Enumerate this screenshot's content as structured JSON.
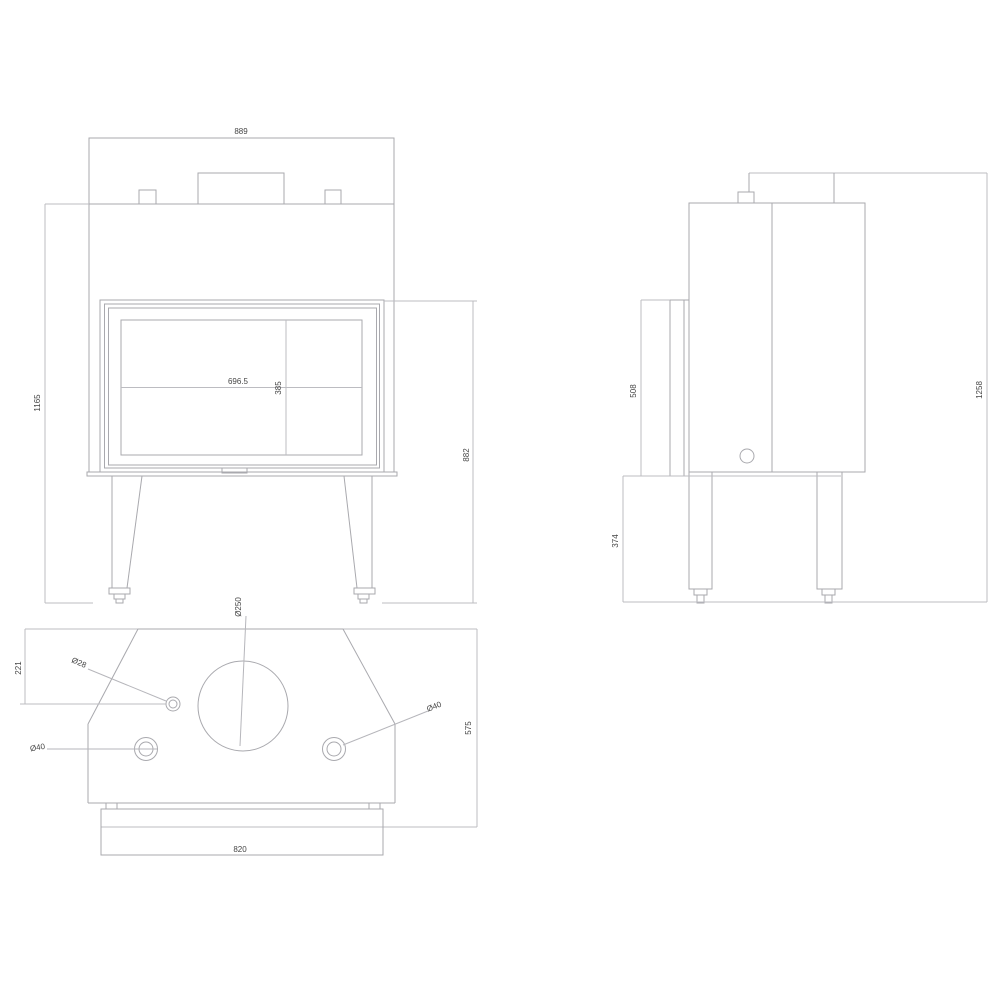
{
  "page": {
    "background": "#ffffff"
  },
  "drawing": {
    "type": "technical-drawing",
    "subject": "fireplace insert, three orthographic views",
    "line_color": "#a9a9ae",
    "dim_line_color": "#bcbcc1",
    "text_color": "#454545",
    "views": [
      {
        "id": "front",
        "title": "front view"
      },
      {
        "id": "side",
        "title": "side view"
      },
      {
        "id": "top",
        "title": "top view"
      }
    ],
    "dimensions": {
      "front_width": "889",
      "front_total_height": "1165",
      "front_body_height": "882",
      "glass_width": "696.5",
      "glass_height": "385",
      "side_door_height": "508",
      "side_total_height": "1258",
      "side_leg_height": "374",
      "top_back_offset": "221",
      "top_depth": "575",
      "top_base_width": "820",
      "flue_diameter": "Ø250",
      "hole_small_diameter": "Ø28",
      "hole_left_diameter": "Ø40",
      "hole_right_diameter": "Ø40"
    }
  }
}
